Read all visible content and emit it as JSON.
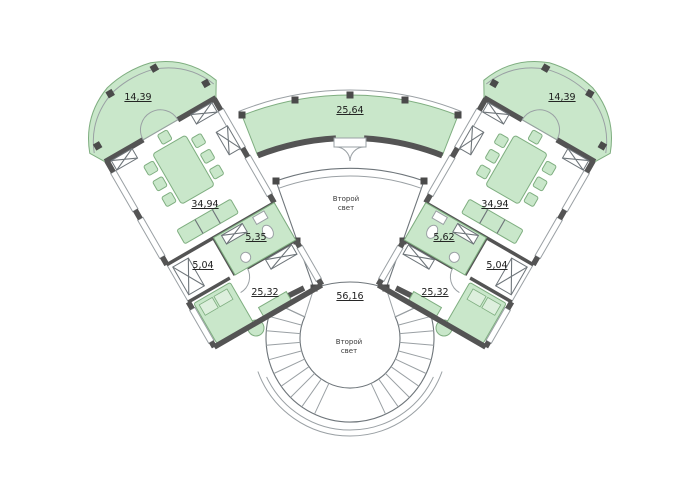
{
  "plan": {
    "areas": {
      "terrace_left": "14,39",
      "terrace_right": "14,39",
      "balcony": "25,64",
      "hall_left": "34,94",
      "hall_right": "34,94",
      "bath_left": "5,35",
      "bath_right": "5,62",
      "small_left": "5,04",
      "small_right": "5,04",
      "bedroom_left": "25,32",
      "bedroom_right": "25,32",
      "stair_hall": "56,16"
    },
    "void_label": {
      "line1": "Второй",
      "line2": "свет"
    }
  },
  "colors": {
    "room_fill": "#c9e7ca",
    "room_fill_light": "#ddefdd",
    "room_stroke": "#7fae80",
    "wall": "#545454",
    "line": "#9aa0a4",
    "line_dark": "#6e757a",
    "column": "#4a4a4a",
    "ink": "#1c1c1c"
  }
}
